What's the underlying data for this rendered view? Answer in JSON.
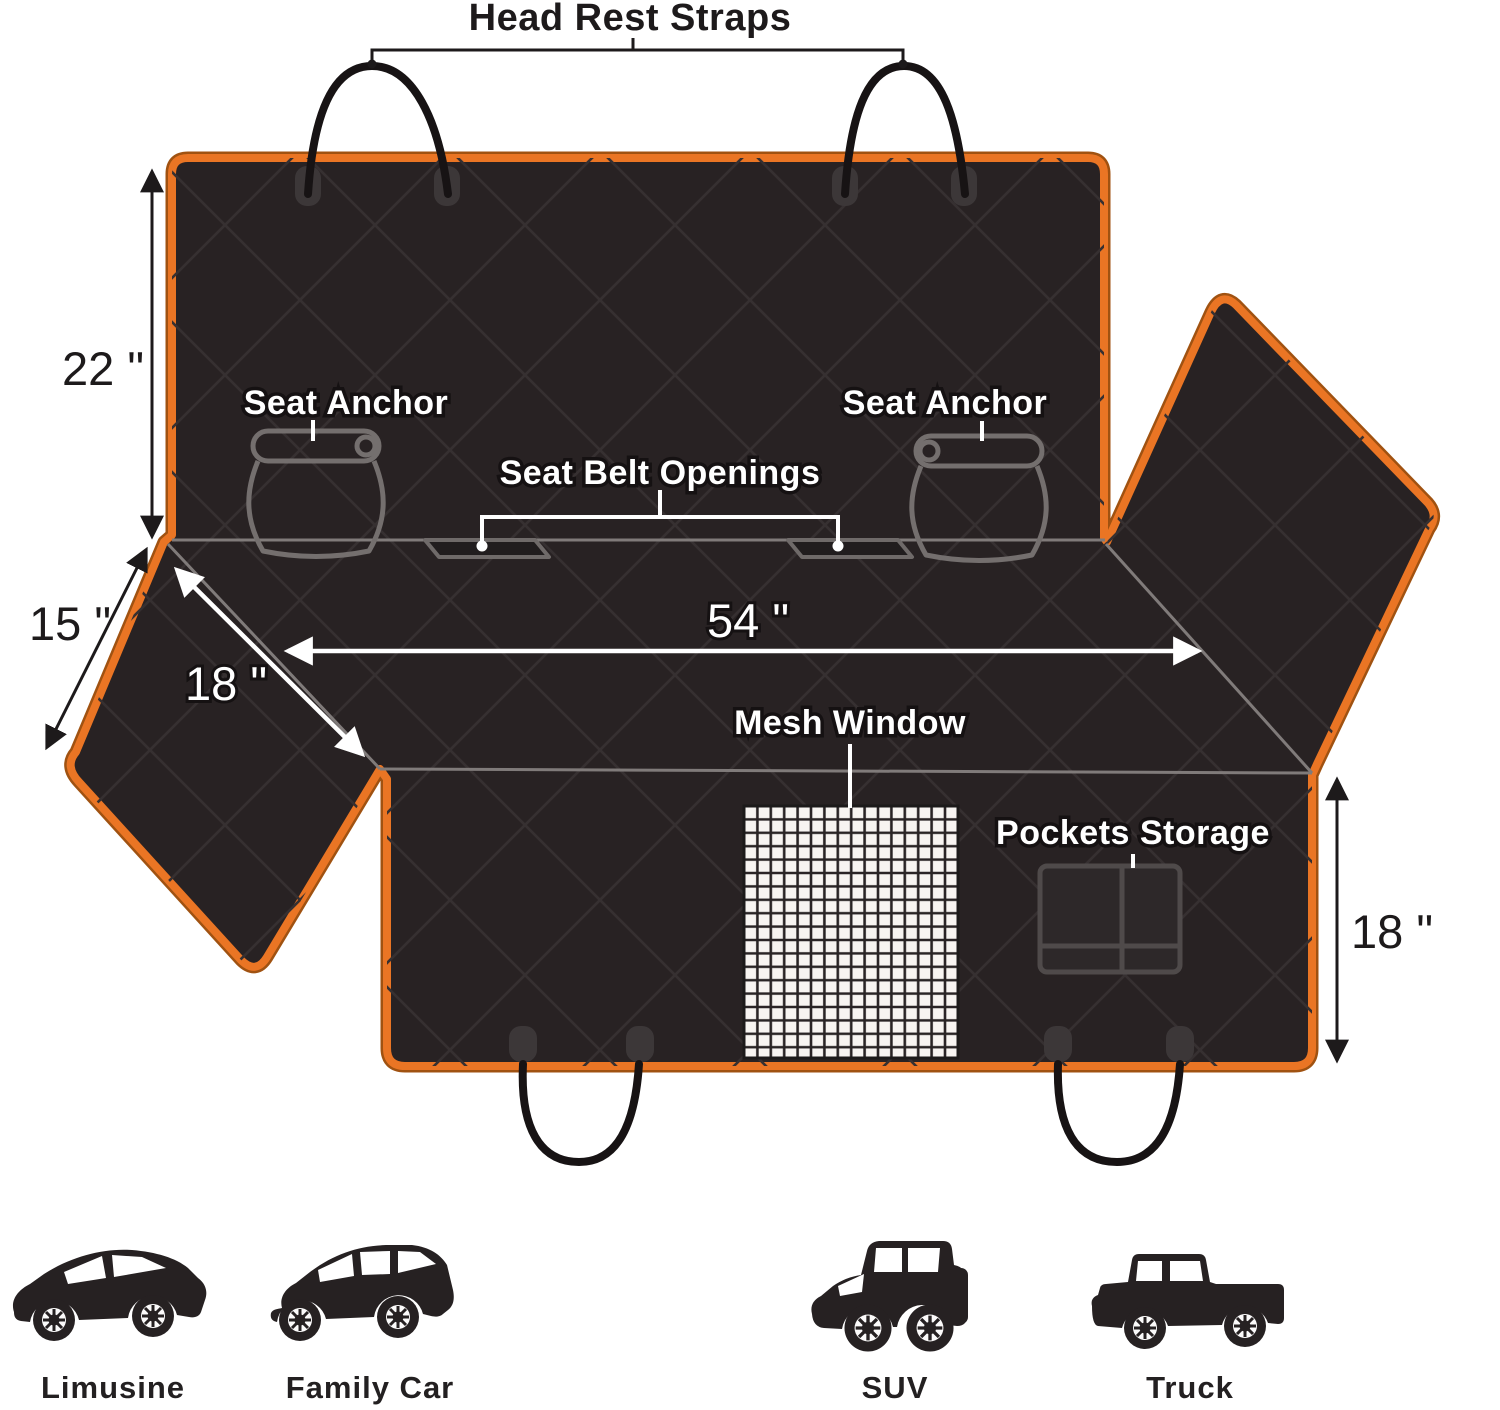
{
  "diagram": {
    "title_note": "dog car seat cover spec diagram",
    "colors": {
      "trim_orange": "#ea7524",
      "fabric_dark": "#282223",
      "line_gray": "#807b7a"
    },
    "labels": {
      "head_rest_straps": "Head Rest Straps",
      "seat_anchor_left": "Seat Anchor",
      "seat_anchor_right": "Seat Anchor",
      "seat_belt_openings": "Seat Belt Openings",
      "mesh_window": "Mesh Window",
      "pockets_storage": "Pockets Storage"
    },
    "dimensions": {
      "back_height": "22 \"",
      "flap_side": "15 \"",
      "seat_flap_depth": "18 \"",
      "seat_width": "54 \"",
      "front_drop": "18 \""
    },
    "vehicles": [
      {
        "label": "Limusine"
      },
      {
        "label": "Family Car"
      },
      {
        "label": "SUV"
      },
      {
        "label": "Truck"
      }
    ]
  }
}
